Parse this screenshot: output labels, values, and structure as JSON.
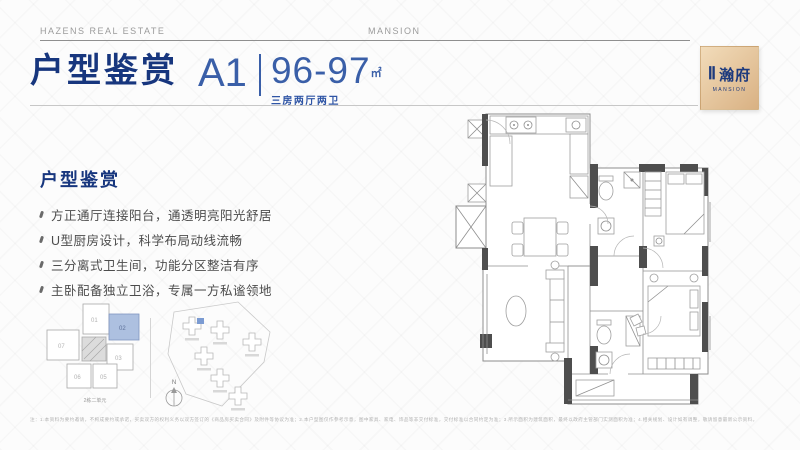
{
  "header": {
    "left": "HAZENS REAL ESTATE",
    "center": "MANSION"
  },
  "title": {
    "heading": "户型鉴赏",
    "unit_label": "A1",
    "area_value": "96-97",
    "area_unit": "㎡",
    "rooms_label": "三房两厅两卫"
  },
  "logo": {
    "numeral": "Ⅱ",
    "name": "瀚府",
    "subtitle": "MANSION"
  },
  "features": {
    "heading": "户型鉴赏",
    "items": [
      "方正通厅连接阳台，通透明亮阳光舒居",
      "U型厨房设计，科学布局动线流畅",
      "三分离式卫生间，功能分区整洁有序",
      "主卧配备独立卫浴，专属一方私谧领地"
    ]
  },
  "keyplan": {
    "units": [
      "01",
      "02",
      "03",
      "05",
      "06",
      "07"
    ],
    "highlighted_unit": "02",
    "caption": "2栋二单元"
  },
  "siteplan": {
    "compass_label": "N"
  },
  "disclaimer": "注：1.本资料为要约邀请，不构成要约或承诺，买卖双方的权利义务以双方签订的《商品房买卖合同》及附件等协议为准；2.本户型图仅作参考示意，图中家具、家电、饰品等非交付标准，交付标准以合同约定为准；3.所示面积为建筑面积，最终以政府主管部门实测面积为准；4.相关规划、设计如有调整，敬请留意最新公示资料。",
  "colors": {
    "primary_blue": "#17367e",
    "accent_blue": "#3a5fa8",
    "logo_gold": "#e4c295",
    "unit_highlight": "#adc0e0",
    "wall_gray": "#4e4e4e"
  }
}
